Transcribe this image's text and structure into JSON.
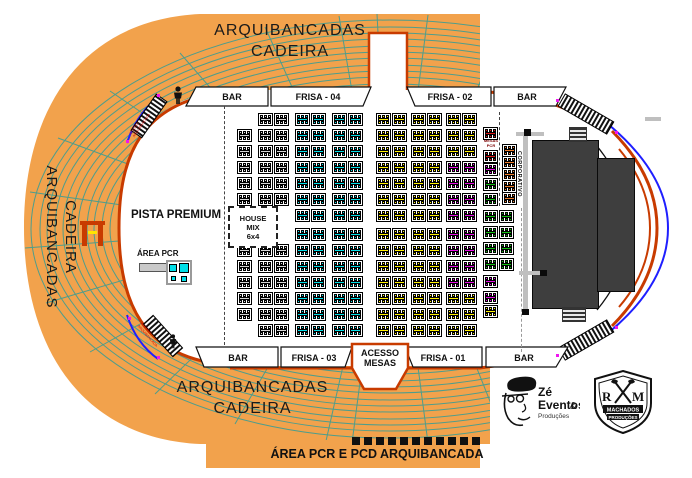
{
  "colors": {
    "orange": "#F2A24C",
    "teal": "#4E9D8C",
    "line": "#C83B00",
    "cyan": "#00DFE8",
    "yellow": "#FFF100",
    "magenta": "#E60CE6",
    "green": "#0FBF0F",
    "red": "#DE1414",
    "corp": "#F07D2A",
    "gray": "#D6D6D6",
    "stage": "#3E3E3E",
    "blue": "#1F1FFF",
    "walkway": "#BFBFBF"
  },
  "texts": {
    "stand_word1": "ARQUIBANCADAS",
    "stand_word2": "CADEIRA",
    "pista": "PISTA PREMIUM",
    "house_mix": [
      "HOUSE",
      "MIX",
      "6x4"
    ],
    "area_pcr": "ÁREA PCR",
    "corporativo": "CORPORATIVO",
    "mesas_pcr1": "MESAS",
    "mesas_pcr2": "PCR",
    "acesso1": "ACESSO",
    "acesso2": "MESAS",
    "banner": "ÁREA PCR E PCD ARQUIBANCADA",
    "ramp_note": "ACESSO ARQUIBANCADA"
  },
  "strips": {
    "top": [
      "BAR",
      "FRISA - 04",
      "FRISA - 02",
      "BAR"
    ],
    "bottom": [
      "BAR",
      "FRISA - 03",
      "FRISA - 01",
      "BAR"
    ]
  },
  "logos": {
    "ze": {
      "l1": "Zé",
      "l2": "Eventos",
      "amp": "&",
      "l3": "Produções"
    },
    "rm": {
      "r": "R",
      "m": "M",
      "n1": "MACHADOS",
      "n2": "PRODUÇÕES"
    }
  },
  "mesas": {
    "blocks": [
      [
        237,
        129,
        "g",
        0
      ],
      [
        237,
        145,
        "g",
        0
      ],
      [
        237,
        161,
        "g",
        0
      ],
      [
        237,
        177,
        "g",
        0
      ],
      [
        237,
        193,
        "g",
        0
      ],
      [
        237,
        244,
        "g",
        0
      ],
      [
        237,
        260,
        "g",
        0
      ],
      [
        237,
        276,
        "g",
        0
      ],
      [
        237,
        292,
        "g",
        0
      ],
      [
        237,
        308,
        "g",
        0
      ],
      [
        258,
        113,
        "g",
        1
      ],
      [
        258,
        129,
        "g",
        1
      ],
      [
        258,
        145,
        "g",
        1
      ],
      [
        258,
        161,
        "g",
        1
      ],
      [
        258,
        177,
        "g",
        1
      ],
      [
        258,
        193,
        "g",
        1
      ],
      [
        258,
        244,
        "g",
        1
      ],
      [
        258,
        260,
        "g",
        1
      ],
      [
        258,
        276,
        "g",
        1
      ],
      [
        258,
        292,
        "g",
        1
      ],
      [
        258,
        308,
        "g",
        1
      ],
      [
        258,
        324,
        "g",
        1
      ],
      [
        295,
        113,
        "c",
        1
      ],
      [
        295,
        129,
        "c",
        1
      ],
      [
        295,
        145,
        "c",
        1
      ],
      [
        295,
        161,
        "c",
        1
      ],
      [
        295,
        177,
        "c",
        1
      ],
      [
        295,
        193,
        "c",
        1
      ],
      [
        295,
        209,
        "c",
        1
      ],
      [
        295,
        228,
        "c",
        1
      ],
      [
        295,
        244,
        "c",
        1
      ],
      [
        295,
        260,
        "c",
        1
      ],
      [
        295,
        276,
        "c",
        1
      ],
      [
        295,
        292,
        "c",
        1
      ],
      [
        295,
        308,
        "c",
        1
      ],
      [
        295,
        324,
        "c",
        1
      ],
      [
        332,
        113,
        "c",
        1
      ],
      [
        332,
        129,
        "c",
        1
      ],
      [
        332,
        145,
        "c",
        1
      ],
      [
        332,
        161,
        "c",
        1
      ],
      [
        332,
        177,
        "c",
        1
      ],
      [
        332,
        193,
        "c",
        1
      ],
      [
        332,
        209,
        "c",
        1
      ],
      [
        332,
        228,
        "c",
        1
      ],
      [
        332,
        244,
        "c",
        1
      ],
      [
        332,
        260,
        "c",
        1
      ],
      [
        332,
        276,
        "c",
        1
      ],
      [
        332,
        292,
        "c",
        1
      ],
      [
        332,
        308,
        "c",
        1
      ],
      [
        332,
        324,
        "c",
        1
      ],
      [
        376,
        113,
        "y",
        1
      ],
      [
        376,
        129,
        "y",
        1
      ],
      [
        376,
        145,
        "y",
        1
      ],
      [
        376,
        161,
        "y",
        1
      ],
      [
        376,
        177,
        "y",
        1
      ],
      [
        376,
        193,
        "y",
        1
      ],
      [
        376,
        209,
        "y",
        1
      ],
      [
        376,
        228,
        "y",
        1
      ],
      [
        376,
        244,
        "y",
        1
      ],
      [
        376,
        260,
        "y",
        1
      ],
      [
        376,
        276,
        "y",
        1
      ],
      [
        376,
        292,
        "y",
        1
      ],
      [
        376,
        308,
        "y",
        1
      ],
      [
        376,
        324,
        "y",
        1
      ],
      [
        411,
        113,
        "y",
        1
      ],
      [
        411,
        129,
        "y",
        1
      ],
      [
        411,
        145,
        "y",
        1
      ],
      [
        411,
        161,
        "y",
        1
      ],
      [
        411,
        177,
        "y",
        1
      ],
      [
        411,
        193,
        "y",
        1
      ],
      [
        411,
        209,
        "y",
        1
      ],
      [
        411,
        228,
        "y",
        1
      ],
      [
        411,
        244,
        "y",
        1
      ],
      [
        411,
        260,
        "y",
        1
      ],
      [
        411,
        276,
        "y",
        1
      ],
      [
        411,
        292,
        "y",
        1
      ],
      [
        411,
        308,
        "y",
        1
      ],
      [
        411,
        324,
        "y",
        1
      ],
      [
        446,
        113,
        "y",
        1
      ],
      [
        446,
        129,
        "y",
        1
      ],
      [
        446,
        145,
        "y",
        1
      ],
      [
        446,
        161,
        "m",
        1
      ],
      [
        446,
        177,
        "m",
        1
      ],
      [
        446,
        193,
        "m",
        1
      ],
      [
        446,
        209,
        "m",
        1
      ],
      [
        446,
        228,
        "m",
        1
      ],
      [
        446,
        244,
        "m",
        1
      ],
      [
        446,
        260,
        "m",
        1
      ],
      [
        446,
        276,
        "m",
        1
      ],
      [
        446,
        292,
        "y",
        1
      ],
      [
        446,
        308,
        "y",
        1
      ],
      [
        446,
        324,
        "y",
        1
      ],
      [
        483,
        127,
        "r",
        0
      ],
      [
        483,
        150,
        "r",
        0
      ],
      [
        483,
        163,
        "m",
        0
      ],
      [
        483,
        178,
        "n",
        0
      ],
      [
        483,
        193,
        "n",
        0
      ],
      [
        483,
        210,
        "n",
        1
      ],
      [
        483,
        226,
        "n",
        1
      ],
      [
        483,
        242,
        "n",
        1
      ],
      [
        483,
        258,
        "n",
        1
      ],
      [
        483,
        275,
        "m",
        0
      ],
      [
        483,
        291,
        "m",
        0
      ],
      [
        483,
        305,
        "y",
        0
      ],
      [
        502,
        144,
        "o",
        0
      ],
      [
        502,
        156,
        "o",
        0
      ],
      [
        502,
        168,
        "o",
        0
      ],
      [
        502,
        180,
        "o",
        0
      ],
      [
        502,
        192,
        "o",
        0
      ]
    ]
  }
}
